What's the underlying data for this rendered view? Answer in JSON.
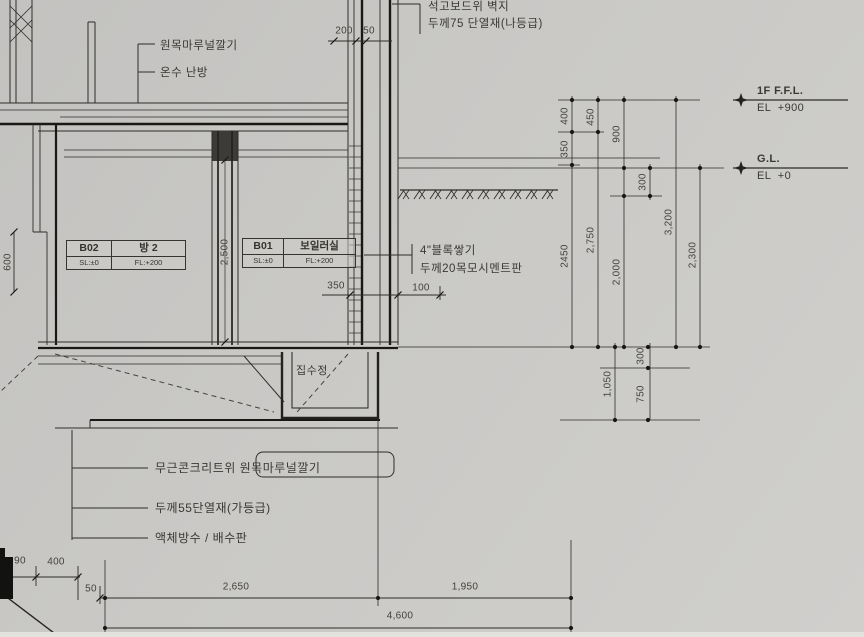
{
  "drawing": {
    "title": "지하층 단면 상세 (basement wall / floor section detail)",
    "notes": {
      "top": [
        "석고보드위 벽지",
        "두께75 단열재(나등급)"
      ],
      "floor1_a": "원목마루널깔기",
      "floor1_b": "온수 난방",
      "wall_a": "4\"블록쌓기",
      "wall_b": "두께20목모시멘트판",
      "sump": "집수정",
      "bottom_a": "무근콘크리트위 원목마루널깔기",
      "bottom_b": "두께55단열재(가등급)",
      "bottom_c": "액체방수 / 배수판"
    },
    "rooms": [
      {
        "code": "B02",
        "name": "방  2",
        "sl": "SL:±0",
        "fl": "FL:+200"
      },
      {
        "code": "B01",
        "name": "보일러실",
        "sl": "SL:±0",
        "fl": "FL:+200"
      }
    ],
    "levels": [
      {
        "name": "1F F.F.L.",
        "elev": "EL  +900"
      },
      {
        "name": "G.L.",
        "elev": "EL  +0"
      }
    ],
    "dims": [
      {
        "t": "200",
        "x": 344,
        "y": 31,
        "r": 0
      },
      {
        "t": "50",
        "x": 369,
        "y": 31,
        "r": 0
      },
      {
        "t": "350",
        "x": 336,
        "y": 286,
        "r": 0
      },
      {
        "t": "100",
        "x": 421,
        "y": 288,
        "r": 0
      },
      {
        "t": "90",
        "x": 20,
        "y": 561,
        "r": 0
      },
      {
        "t": "400",
        "x": 56,
        "y": 562,
        "r": 0
      },
      {
        "t": "50",
        "x": 91,
        "y": 589,
        "r": 0
      },
      {
        "t": "2,650",
        "x": 236,
        "y": 587,
        "r": 0
      },
      {
        "t": "1,950",
        "x": 465,
        "y": 587,
        "r": 0
      },
      {
        "t": "4,600",
        "x": 400,
        "y": 616,
        "r": 0
      },
      {
        "t": "400",
        "x": 565,
        "y": 116,
        "r": 1
      },
      {
        "t": "350",
        "x": 565,
        "y": 149,
        "r": 1
      },
      {
        "t": "450",
        "x": 591,
        "y": 117,
        "r": 1
      },
      {
        "t": "900",
        "x": 617,
        "y": 134,
        "r": 1
      },
      {
        "t": "300",
        "x": 643,
        "y": 182,
        "r": 1
      },
      {
        "t": "2450",
        "x": 565,
        "y": 256,
        "r": 1
      },
      {
        "t": "2,750",
        "x": 591,
        "y": 240,
        "r": 1
      },
      {
        "t": "2,000",
        "x": 617,
        "y": 272,
        "r": 1
      },
      {
        "t": "3,200",
        "x": 669,
        "y": 222,
        "r": 1
      },
      {
        "t": "2,300",
        "x": 693,
        "y": 255,
        "r": 1
      },
      {
        "t": "1,050",
        "x": 608,
        "y": 384,
        "r": 1
      },
      {
        "t": "300",
        "x": 641,
        "y": 356,
        "r": 1
      },
      {
        "t": "750",
        "x": 641,
        "y": 394,
        "r": 1
      },
      {
        "t": "2,500",
        "x": 225,
        "y": 252,
        "r": 1
      },
      {
        "t": "600",
        "x": 8,
        "y": 262,
        "r": 1
      }
    ],
    "colors": {
      "paper": "#c9c8c5",
      "ink": "#2e2d29",
      "ink_heavy": "#191815"
    }
  }
}
